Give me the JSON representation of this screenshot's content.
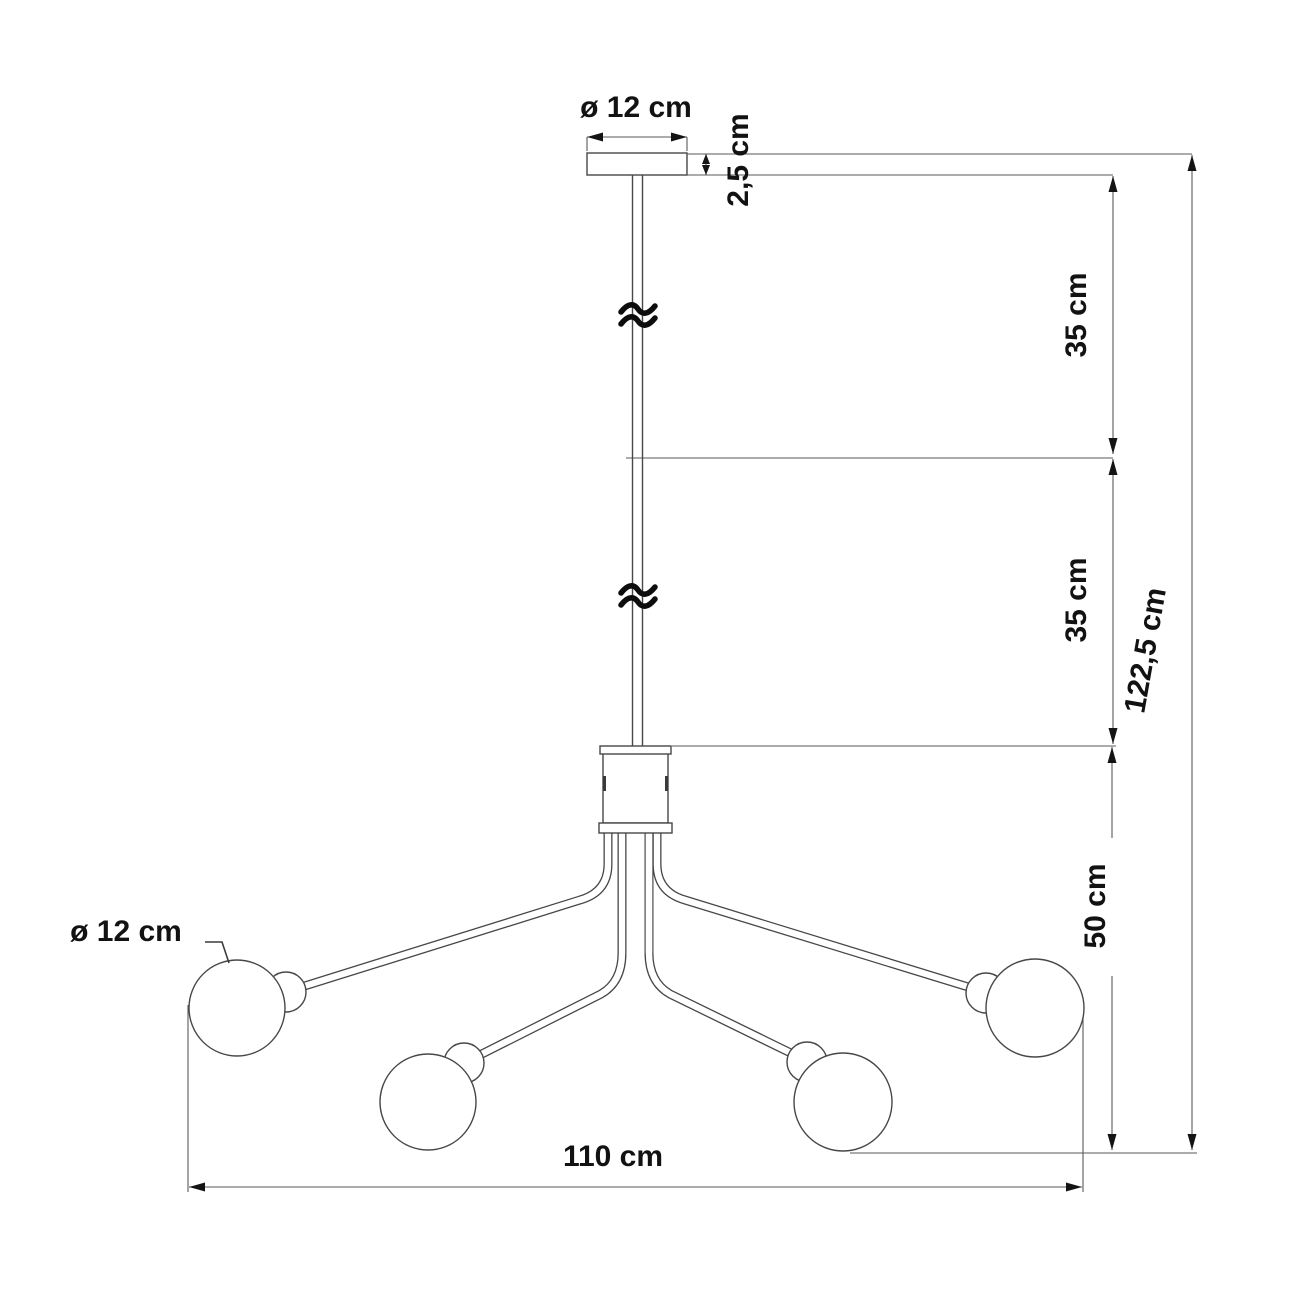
{
  "drawing": {
    "type": "pendant-chandelier-dimension-diagram",
    "labels": {
      "canopy_diameter": "ø 12 cm",
      "canopy_thickness": "2,5 cm",
      "upper_rod_segment": "35 cm",
      "lower_rod_segment": "35 cm",
      "arm_drop_height": "50 cm",
      "overall_height": "122,5 cm",
      "overall_width": "110 cm",
      "globe_diameter": "ø 12 cm"
    },
    "dimensions": [
      {
        "name": "canopy diameter",
        "value": "ø 12 cm"
      },
      {
        "name": "canopy thickness",
        "value": "2,5 cm"
      },
      {
        "name": "upper rod segment",
        "value": "35 cm"
      },
      {
        "name": "lower rod segment",
        "value": "35 cm"
      },
      {
        "name": "arm drop height",
        "value": "50 cm"
      },
      {
        "name": "overall height",
        "value": "122,5 cm"
      },
      {
        "name": "overall width",
        "value": "110 cm"
      },
      {
        "name": "globe diameter",
        "value": "ø 12 cm"
      }
    ],
    "colors": {
      "background": "#ffffff",
      "fixture_line": "#474747",
      "dimension_line": "#5a5a5a",
      "text": "#121212"
    }
  }
}
